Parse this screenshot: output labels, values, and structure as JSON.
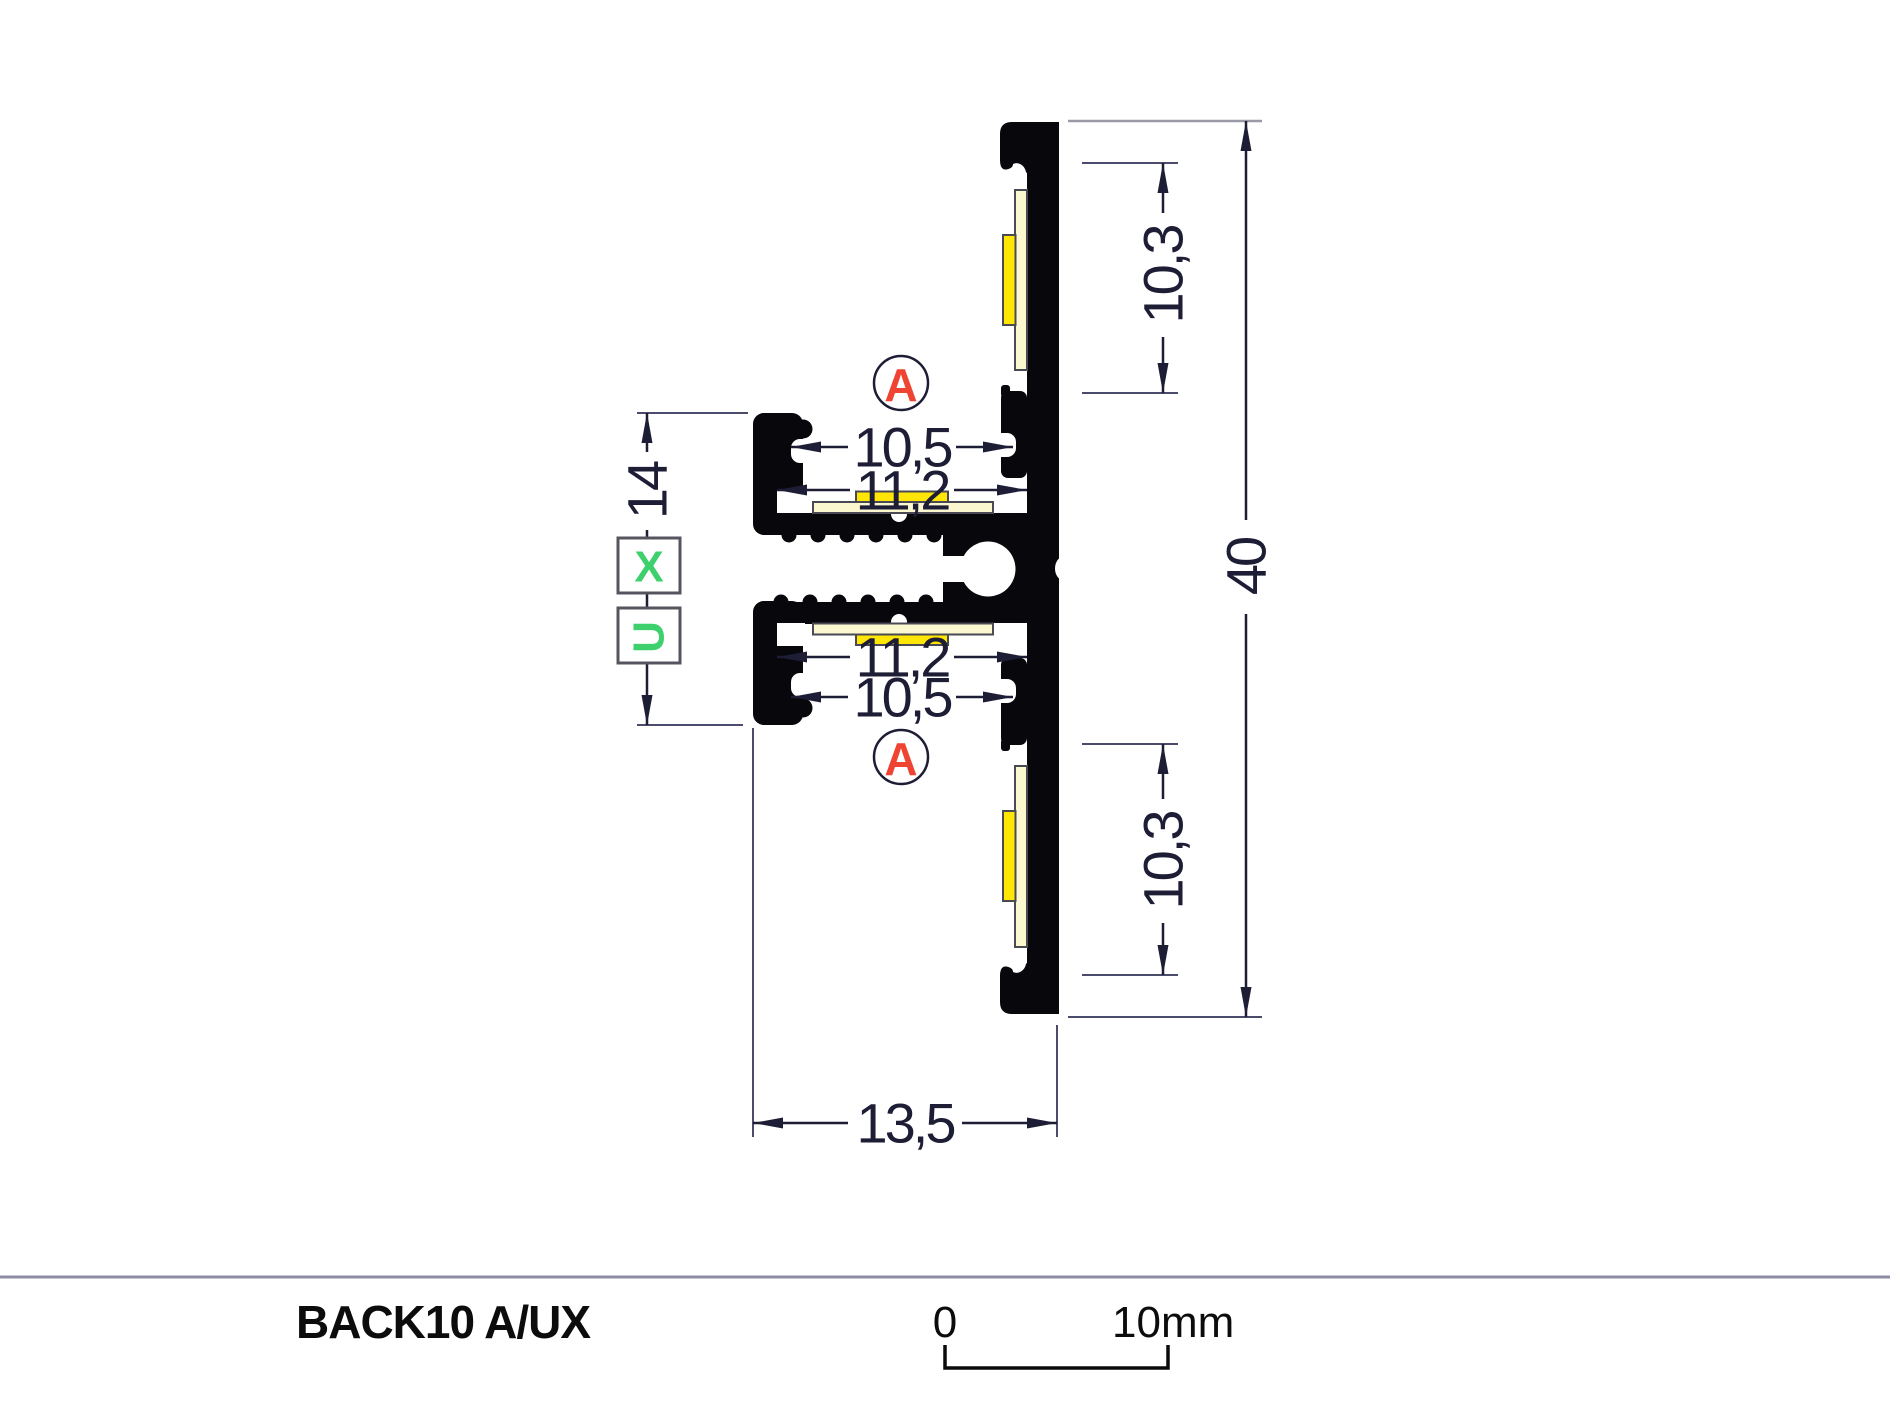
{
  "drawing": {
    "detail_marker_top": "A",
    "detail_marker_bottom": "A",
    "variant_x": "X",
    "variant_u": "U",
    "dims": {
      "overall_height": "40",
      "led_pocket_top": "10,3",
      "led_pocket_bottom": "10,3",
      "opening_top": "10,5",
      "opening_bottom": "10,5",
      "channel_top": "11,2",
      "channel_bottom": "11,2",
      "side_depth": "14",
      "overall_width": "13,5"
    }
  },
  "footer": {
    "product_name": "BACK10 A/UX",
    "scale_zero": "0",
    "scale_ten": "10mm"
  },
  "colors": {
    "profile": "#07070c",
    "led_pcb": "#fbf8d0",
    "led_chip": "#ffe604",
    "marker_red": "#ee4431",
    "marker_green": "#3fd06e",
    "dim": "#1d1d35",
    "ext": "#4b4b6b",
    "ext_light": "#9a9aa8",
    "separator": "#8c8ca6",
    "strip_border": "#4a4a55"
  }
}
